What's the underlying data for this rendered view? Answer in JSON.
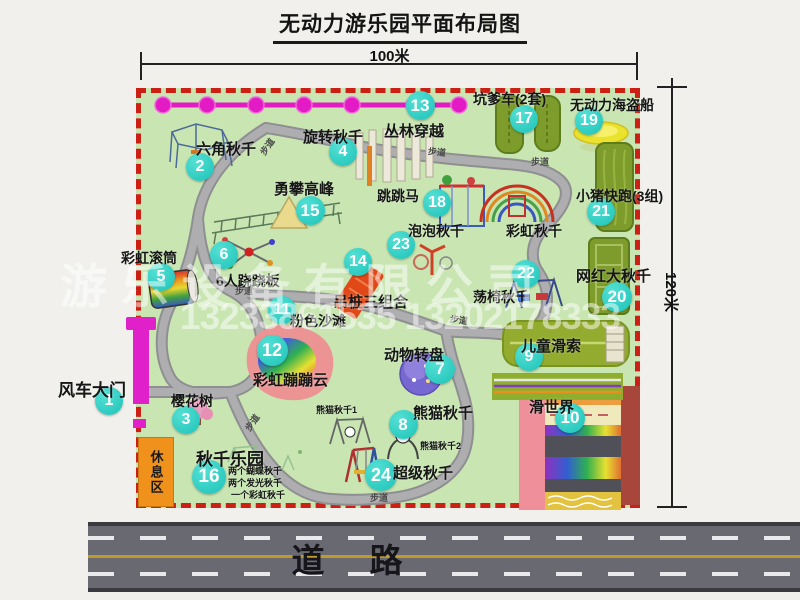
{
  "title": "无动力游乐园平面布局图",
  "dimensions": {
    "width_label": "100米",
    "height_label": "120米"
  },
  "road": {
    "label": "道　路"
  },
  "watermark": {
    "company": "游乐设备有限公司",
    "phones": "13233861535 13202178333"
  },
  "rest_area": {
    "label": "休息区"
  },
  "colors": {
    "map_green": "#c8e5b2",
    "border_red": "#cc2015",
    "badge_teal": "#1cc2b8",
    "magenta": "#e31bc4",
    "olive_track": "#7d9c2c",
    "rest_orange": "#f0911c",
    "road_gray": "#696971",
    "pirate_yellow": "#ebe22e",
    "carousel_purple": "#7668d0"
  },
  "map": {
    "pois": [
      {
        "num": "1",
        "label": "风车大门",
        "badge": {
          "x": 109,
          "y": 401
        },
        "label_pos": {
          "x": 58,
          "y": 376
        },
        "size": 17
      },
      {
        "num": "2",
        "label": "六角秋千",
        "badge": {
          "x": 200,
          "y": 167
        },
        "label_pos": {
          "x": 196,
          "y": 138
        },
        "size": 15
      },
      {
        "num": "3",
        "label": "樱花树",
        "badge": {
          "x": 186,
          "y": 420
        },
        "label_pos": {
          "x": 171,
          "y": 391
        },
        "size": 14
      },
      {
        "num": "4",
        "label": "旋转秋千",
        "badge": {
          "x": 343,
          "y": 152
        },
        "label_pos": {
          "x": 303,
          "y": 126
        },
        "size": 15
      },
      {
        "num": "5",
        "label": "彩虹滚筒",
        "badge": {
          "x": 161,
          "y": 277
        },
        "label_pos": {
          "x": 121,
          "y": 248
        },
        "size": 14
      },
      {
        "num": "6",
        "label": "6人跷跷板",
        "badge": {
          "x": 224,
          "y": 255
        },
        "label_pos": {
          "x": 216,
          "y": 271
        },
        "size": 14
      },
      {
        "num": "7",
        "label": "动物转盘",
        "badge": {
          "x": 440,
          "y": 369
        },
        "d": 30,
        "label_pos": {
          "x": 384,
          "y": 344
        },
        "size": 15
      },
      {
        "num": "8",
        "label": "熊猫秋千",
        "badge": {
          "x": 403,
          "y": 424
        },
        "d": 29,
        "label_pos": {
          "x": 413,
          "y": 402
        },
        "size": 15
      },
      {
        "num": "9",
        "label": "儿童滑索",
        "badge": {
          "x": 529,
          "y": 357
        },
        "label_pos": {
          "x": 521,
          "y": 335
        },
        "size": 15
      },
      {
        "num": "10",
        "label": "滑世界",
        "badge": {
          "x": 570,
          "y": 418
        },
        "d": 30,
        "label_pos": {
          "x": 529,
          "y": 396
        },
        "size": 15
      },
      {
        "num": "11",
        "label": "粉色沙滩",
        "badge": {
          "x": 282,
          "y": 310
        },
        "label_pos": {
          "x": 290,
          "y": 311
        },
        "size": 14
      },
      {
        "num": "12",
        "label": "彩虹蹦蹦云",
        "badge": {
          "x": 272,
          "y": 350
        },
        "d": 31,
        "label_pos": {
          "x": 253,
          "y": 369
        },
        "size": 15
      },
      {
        "num": "13",
        "label": "丛林穿越",
        "badge": {
          "x": 420,
          "y": 105
        },
        "d": 29,
        "label_pos": {
          "x": 384,
          "y": 120
        },
        "size": 15
      },
      {
        "num": "14",
        "label": "吊桩三组合",
        "badge": {
          "x": 358,
          "y": 262
        },
        "label_pos": {
          "x": 333,
          "y": 291
        },
        "size": 15
      },
      {
        "num": "15",
        "label": "勇攀高峰",
        "badge": {
          "x": 310,
          "y": 210
        },
        "d": 29,
        "label_pos": {
          "x": 274,
          "y": 178
        },
        "size": 15
      },
      {
        "num": "16",
        "label": "秋千乐园",
        "badge": {
          "x": 209,
          "y": 477
        },
        "d": 34,
        "label_pos": {
          "x": 196,
          "y": 445
        },
        "size": 17
      },
      {
        "num": "17",
        "label": "坑爹车(2套)",
        "badge": {
          "x": 524,
          "y": 119
        },
        "label_pos": {
          "x": 473,
          "y": 89
        },
        "size": 14
      },
      {
        "num": "18",
        "label": "跳跳马",
        "badge": {
          "x": 437,
          "y": 203
        },
        "label_pos": {
          "x": 377,
          "y": 186
        },
        "size": 14
      },
      {
        "num": "19",
        "label": "无动力海盗船",
        "badge": {
          "x": 589,
          "y": 121
        },
        "label_pos": {
          "x": 570,
          "y": 95
        },
        "size": 14
      },
      {
        "num": "20",
        "label": "网红大秋千",
        "badge": {
          "x": 617,
          "y": 297
        },
        "d": 30,
        "label_pos": {
          "x": 576,
          "y": 265
        },
        "size": 15
      },
      {
        "num": "21",
        "label": "小猪快跑(3组)",
        "badge": {
          "x": 601,
          "y": 212
        },
        "label_pos": {
          "x": 576,
          "y": 186
        },
        "size": 14
      },
      {
        "num": "22",
        "label": "荡椅秋千",
        "badge": {
          "x": 526,
          "y": 274
        },
        "label_pos": {
          "x": 473,
          "y": 287
        },
        "size": 14
      },
      {
        "num": "23",
        "label": "泡泡秋千",
        "badge": {
          "x": 401,
          "y": 245
        },
        "label_pos": {
          "x": 408,
          "y": 221
        },
        "size": 14
      },
      {
        "num": "24",
        "label": "超级秋千",
        "badge": {
          "x": 381,
          "y": 475
        },
        "d": 32,
        "label_pos": {
          "x": 393,
          "y": 462
        },
        "size": 15
      }
    ],
    "extra_labels": [
      {
        "text": "彩虹秋千",
        "x": 506,
        "y": 221,
        "size": 14
      },
      {
        "text": "熊猫秋千1",
        "x": 316,
        "y": 403,
        "size": 9
      },
      {
        "text": "熊猫秋千2",
        "x": 420,
        "y": 439,
        "size": 9
      },
      {
        "text": "两个蝴蝶秋千",
        "x": 228,
        "y": 464,
        "size": 9
      },
      {
        "text": "两个发光秋千",
        "x": 228,
        "y": 476,
        "size": 9
      },
      {
        "text": "一个彩虹秋千",
        "x": 231,
        "y": 488,
        "size": 9
      }
    ],
    "path_labels": [
      {
        "text": "步道",
        "x": 258,
        "y": 140,
        "rot": -55
      },
      {
        "text": "步道",
        "x": 428,
        "y": 145,
        "rot": 6
      },
      {
        "text": "步道",
        "x": 531,
        "y": 155,
        "rot": 0
      },
      {
        "text": "步道",
        "x": 235,
        "y": 284,
        "rot": 0
      },
      {
        "text": "步道",
        "x": 243,
        "y": 416,
        "rot": -55
      },
      {
        "text": "步道",
        "x": 370,
        "y": 491,
        "rot": 0
      },
      {
        "text": "步道",
        "x": 450,
        "y": 313,
        "rot": 8
      }
    ]
  }
}
